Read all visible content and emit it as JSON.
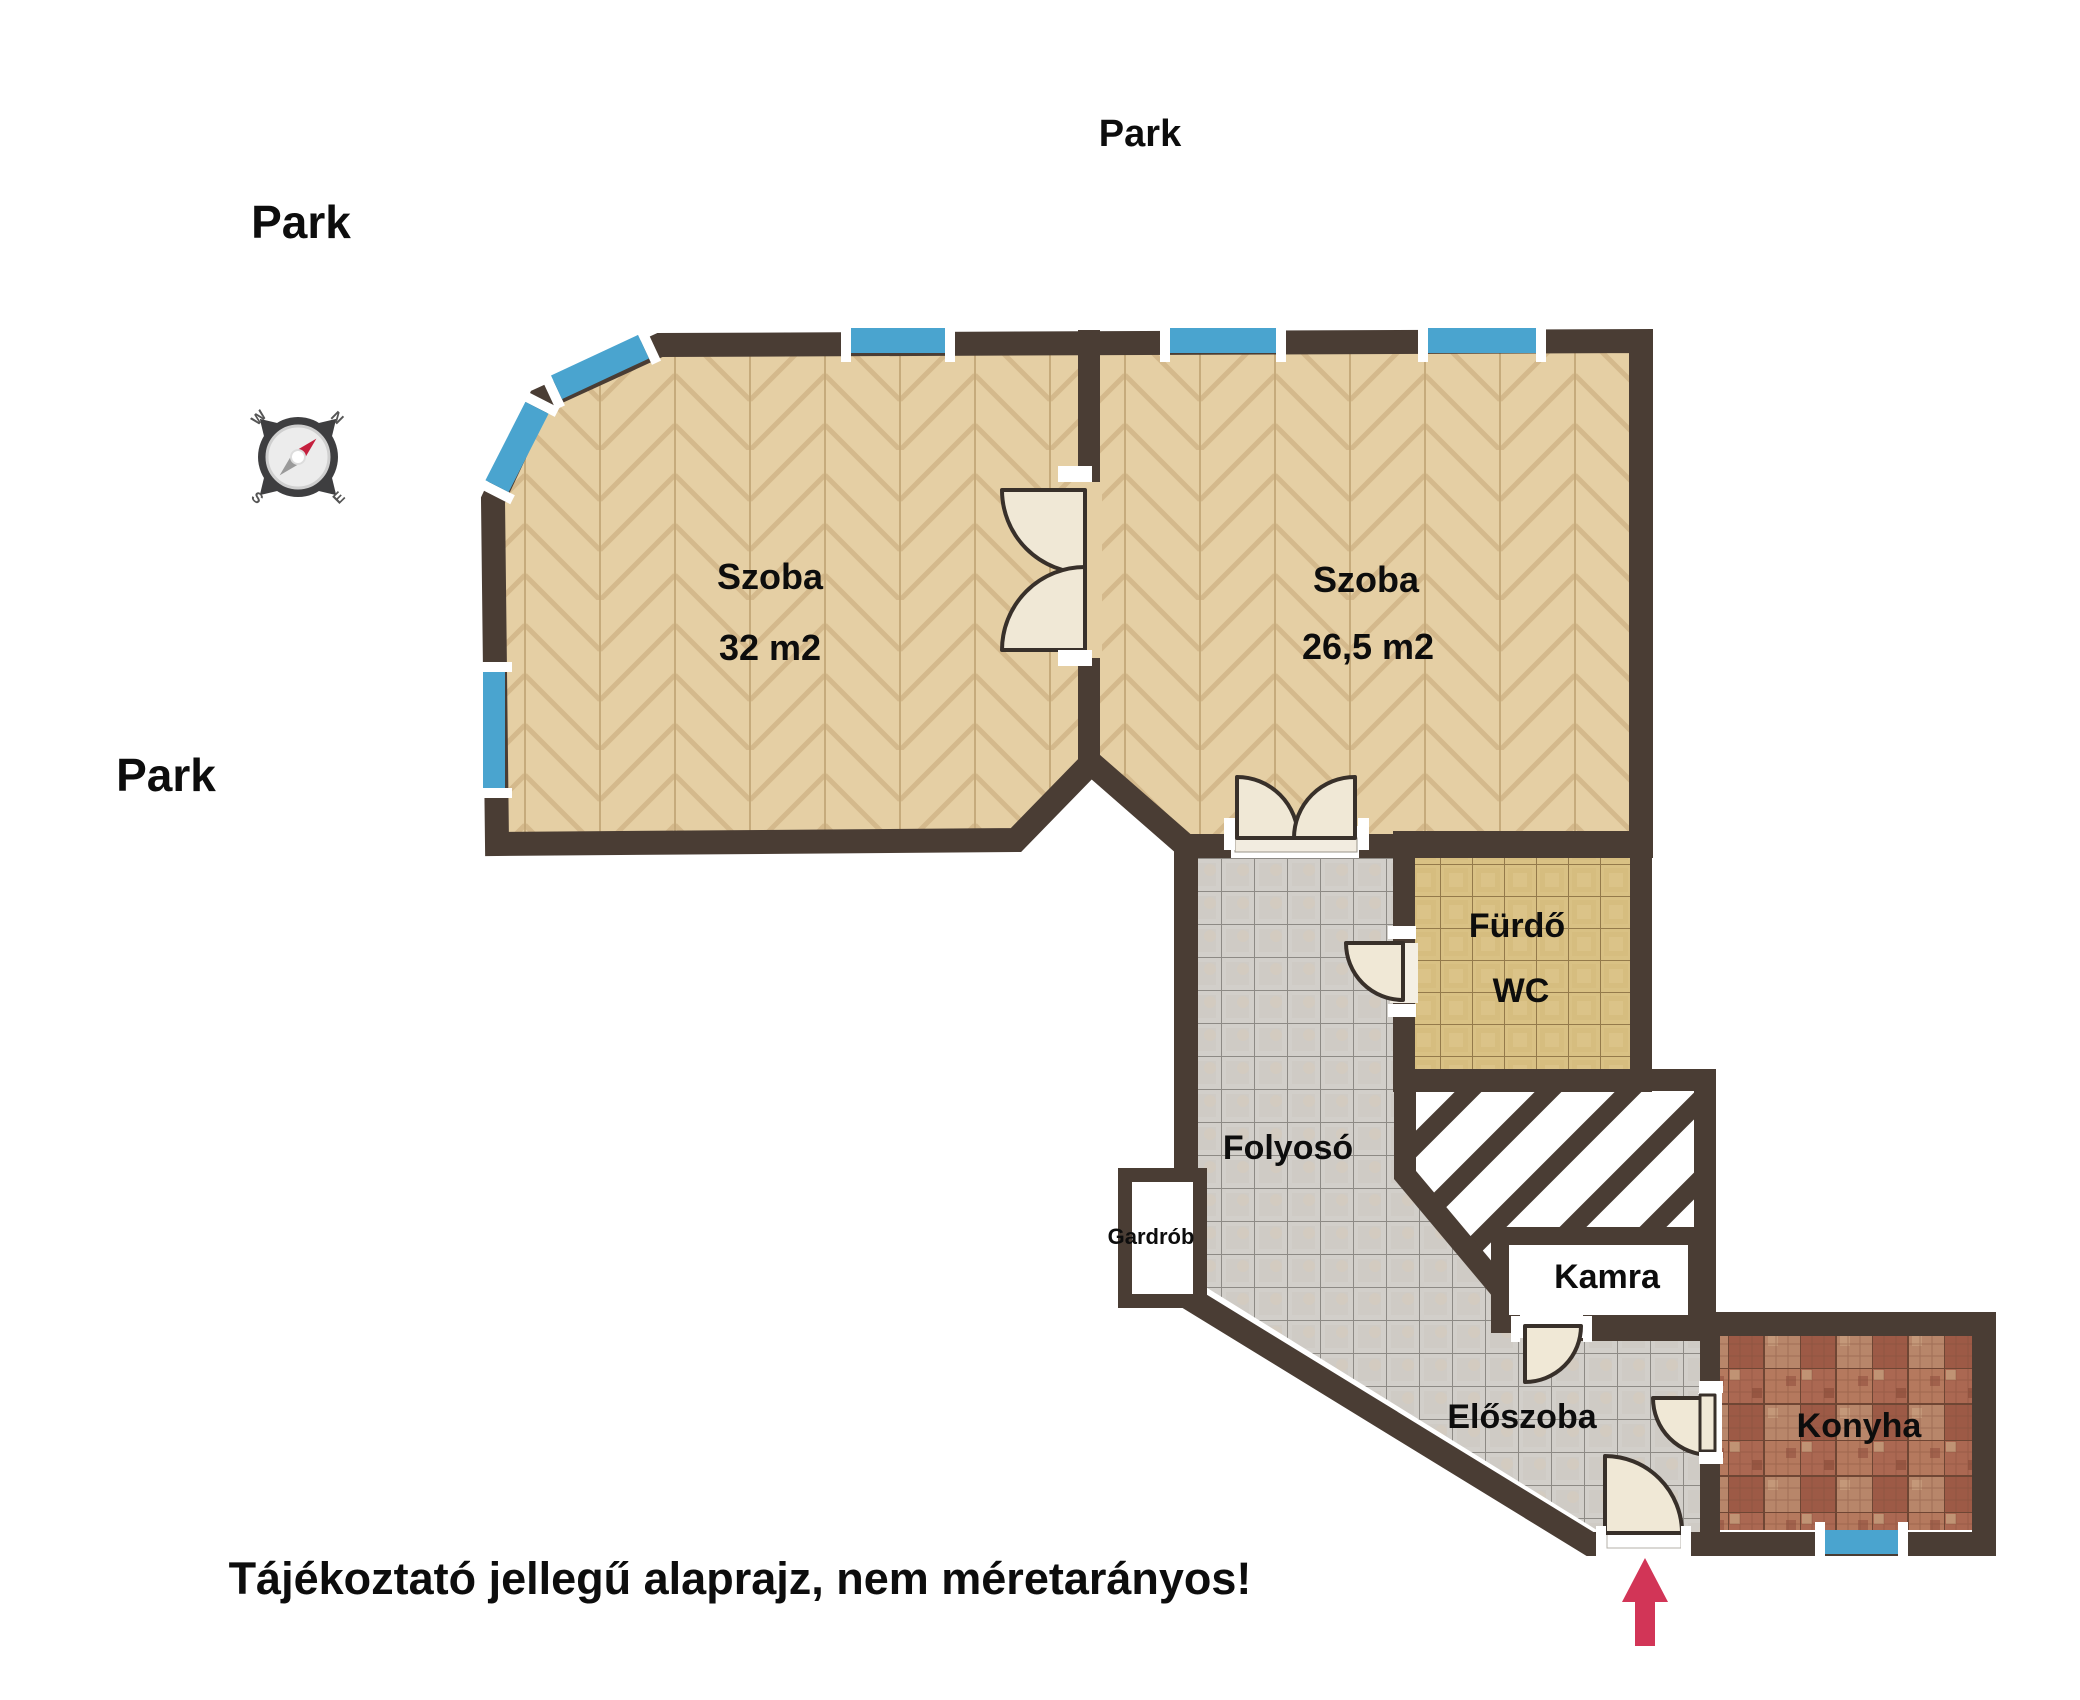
{
  "surroundings": {
    "park_top": "Park",
    "park_upper_left": "Park",
    "park_left": "Park"
  },
  "disclaimer": "Tájékoztató jellegű alaprajz, nem méretarányos!",
  "compass": {
    "n": "N",
    "e": "E",
    "s": "S",
    "w": "W"
  },
  "rooms": {
    "szoba1": {
      "label": "Szoba",
      "area": "32 m2"
    },
    "szoba2": {
      "label": "Szoba",
      "area": "26,5 m2"
    },
    "furdo": {
      "label": "Fürdő",
      "label2": "WC"
    },
    "folyoso": {
      "label": "Folyosó"
    },
    "gardrob": {
      "label": "Gardrób"
    },
    "kamra": {
      "label": "Kamra"
    },
    "eloszoba": {
      "label": "Előszoba"
    },
    "konyha": {
      "label": "Konyha"
    }
  },
  "colors": {
    "wall": "#4a3d34",
    "window_blue": "#4aa4cf",
    "entrance_arrow": "#d23557",
    "wood_floor": "#e5cfa4",
    "bath_tile": "#d9c184",
    "hall_tile": "#d2cfca",
    "kitchen_mosaic": "#a96450",
    "door_leaf": "#f0e8d6"
  }
}
